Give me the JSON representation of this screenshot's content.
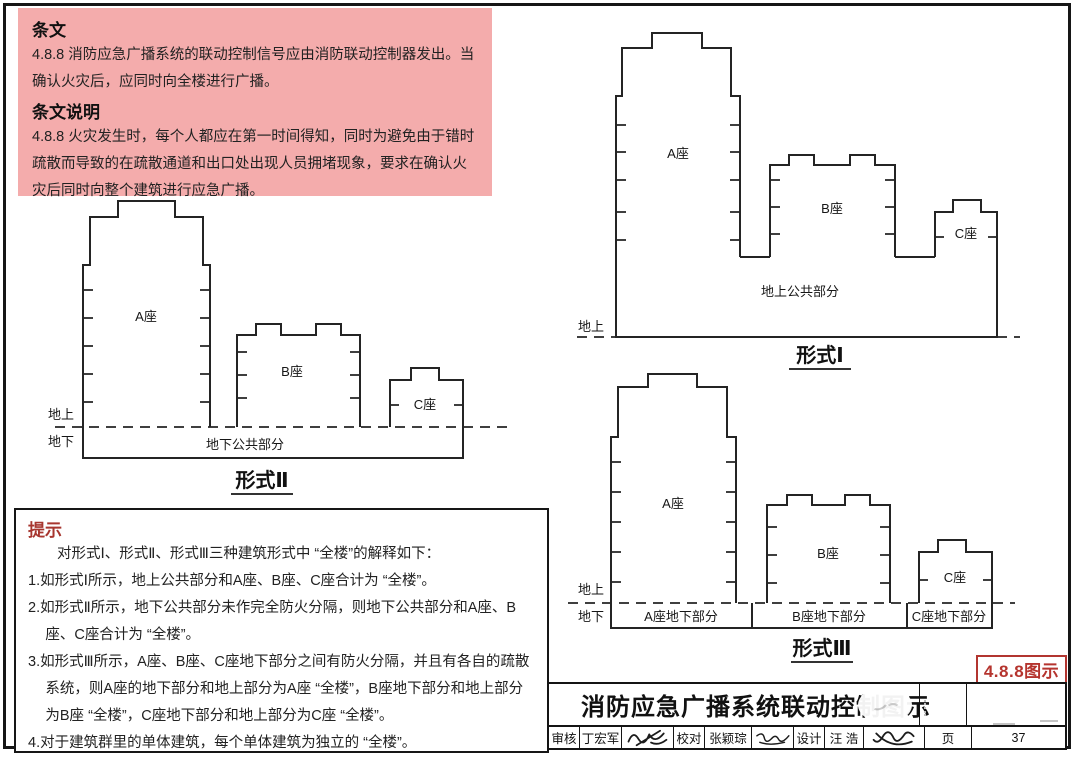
{
  "page": {
    "clause_box": {
      "heading1": "条文",
      "clause_text": "4.8.8  消防应急广播系统的联动控制信号应由消防联动控制器发出。当确认火灾后，应同时向全楼进行广播。",
      "heading2": "条文说明",
      "explanation_text": "4.8.8  火灾发生时，每个人都应在第一时间得知，同时为避免由于错时疏散而导致的在疏散通道和出口处出现人员拥堵现象，要求在确认火灾后同时向整个建筑进行应急广播。"
    },
    "tips_box": {
      "heading": "提示",
      "intro": "对形式Ⅰ、形式Ⅱ、形式Ⅲ三种建筑形式中 “全楼”的解释如下：",
      "items": [
        "1.如形式Ⅰ所示，地上公共部分和A座、B座、C座合计为 “全楼”。",
        "2.如形式Ⅱ所示，地下公共部分未作完全防火分隔，则地下公共部分和A座、B座、C座合计为 “全楼”。",
        "3.如形式Ⅲ所示，A座、B座、C座地下部分之间有防火分隔，并且有各自的疏散系统，则A座的地下部分和地上部分为A座 “全楼”，B座地下部分和地上部分为B座 “全楼”，C座地下部分和地上部分为C座 “全楼”。",
        "4.对于建筑群里的单体建筑，每个单体建筑为独立的 “全楼”。"
      ]
    },
    "diagrams": {
      "form1": {
        "caption": "形式Ⅰ",
        "tower_a": "A座",
        "tower_b": "B座",
        "tower_c": "C座",
        "podium_label": "地上公共部分",
        "ground_above": "地上"
      },
      "form2": {
        "caption": "形式Ⅱ",
        "tower_a": "A座",
        "tower_b": "B座",
        "tower_c": "C座",
        "podium_label": "地下公共部分",
        "ground_above": "地上",
        "ground_below": "地下"
      },
      "form3": {
        "caption": "形式Ⅲ",
        "tower_a": "A座",
        "tower_b": "B座",
        "tower_c": "C座",
        "basement_a": "A座地下部分",
        "basement_b": "B座地下部分",
        "basement_c": "C座地下部分",
        "ground_above": "地上",
        "ground_below": "地下"
      }
    },
    "figure_tag": "4.8.8图示",
    "title_block": {
      "title": "消防应急广播系统联动控制图示",
      "reviewer_label": "审核",
      "reviewer": "丁宏军",
      "reviewer_signature": "丁宏军",
      "checker_label": "校对",
      "checker": "张颖琮",
      "checker_signature": "张颖琮",
      "designer_label": "设计",
      "designer": "汪 浩",
      "designer_signature": "汪浩",
      "page_label": "页",
      "page_number": "37"
    },
    "colors": {
      "clause_box_bg": "#f4acac",
      "tips_heading_red": "#a7362f",
      "figure_tag_red": "#b23530",
      "line_black": "#161616"
    }
  }
}
